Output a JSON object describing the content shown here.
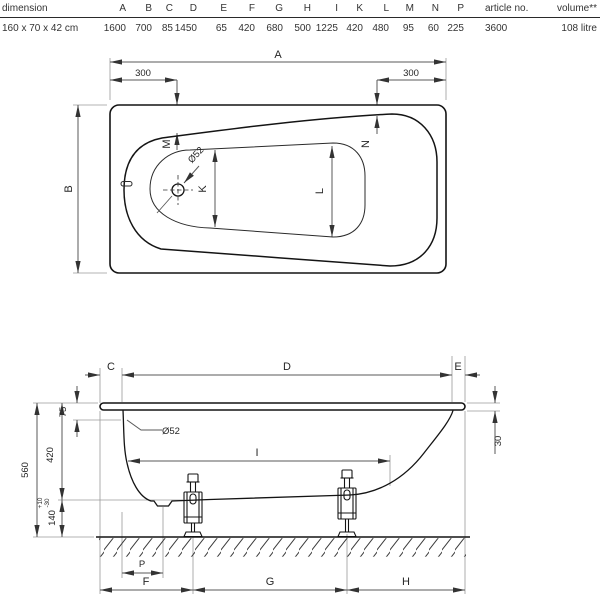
{
  "table": {
    "dimension_header": "dimension",
    "dim_headers": [
      "A",
      "B",
      "C",
      "D",
      "E",
      "F",
      "G",
      "H",
      "I",
      "K",
      "L",
      "M",
      "N",
      "P"
    ],
    "article_header": "article no.",
    "volume_header": "volume**",
    "row": {
      "dimension": "160 x 70 x 42 cm",
      "values": [
        "1600",
        "700",
        "85",
        "1450",
        "65",
        "420",
        "680",
        "500",
        "1225",
        "420",
        "480",
        "95",
        "60",
        "225"
      ],
      "article_no": "3600",
      "volume": "108 litre"
    }
  },
  "top_view": {
    "dim_a": "A",
    "dim_b": "B",
    "offset_left": "300",
    "offset_right": "300",
    "dim_m": "M",
    "dim_n": "N",
    "dim_k": "K",
    "dim_l": "L",
    "drain_diameter": "Ø52"
  },
  "side_view": {
    "dim_c": "C",
    "dim_d": "D",
    "dim_e": "E",
    "rim_to_overflow": "75",
    "inner_depth": "420",
    "total_height": "560",
    "floor_clearance": "140",
    "tolerance_plus": "+10",
    "tolerance_minus": "-30",
    "end_drop": "30",
    "overflow_diameter": "Ø52",
    "dim_i": "I",
    "dim_p": "P",
    "dim_f": "F",
    "dim_g": "G",
    "dim_h": "H"
  }
}
